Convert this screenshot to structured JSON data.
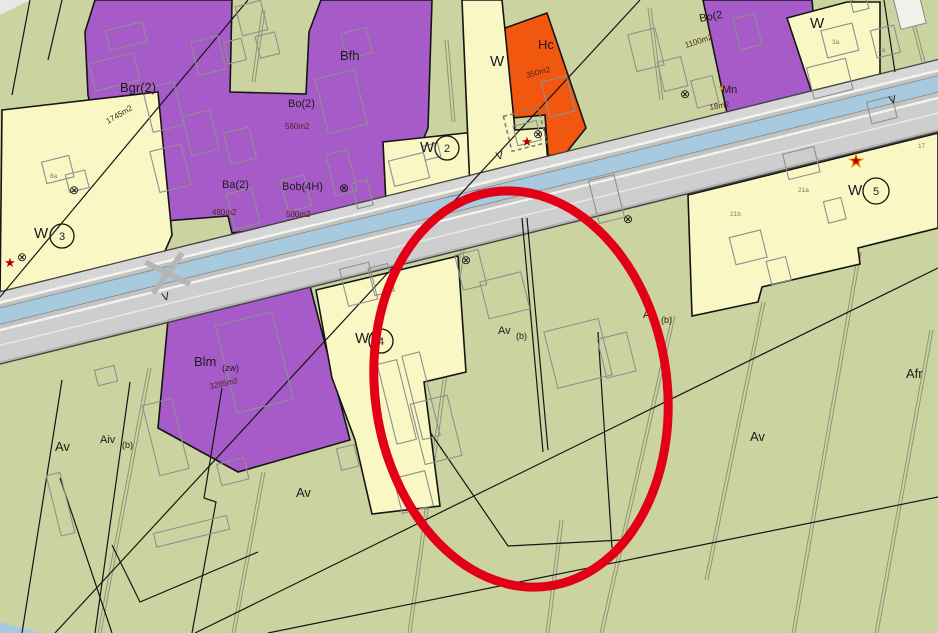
{
  "map": {
    "colors": {
      "farmland_green": "#cbd4a0",
      "zone_purple": "#a75bc9",
      "zone_cream": "#f9f7c4",
      "zone_orange": "#f2570f",
      "road_gray": "#cfcfcf",
      "water_blue": "#a8cade",
      "annotation_red": "#e30016",
      "boundary_black": "#141414",
      "building_outline": "#8f8f8f",
      "star_red": "#b00000",
      "star_orange": "#f09000",
      "area_text_color": "#4a2619"
    },
    "zone_labels": {
      "bgr": "Bgr(2)",
      "bfh": "Bfh",
      "bo2": "Bo(2)",
      "ba2": "Ba(2)",
      "bob4": "Bob(4H)",
      "hc": "Hc",
      "bo2r": "Bo(2",
      "mn": "Mn",
      "blm_main": "Blm",
      "blm_sub": "(zw)",
      "av": "Av",
      "av_sub": "(b)",
      "aiv": "Aiv",
      "afr": "Afr",
      "w": "W",
      "v": "V"
    },
    "area_labels": {
      "bgr": "1745m2",
      "bo2": "560m2",
      "ba2": "480m2",
      "bob4": "500m2",
      "hc": "350m2",
      "bo2r": "1100m2",
      "mn": "18m2",
      "blm": "3285m2"
    },
    "site_numbers": {
      "w2": "2",
      "w3": "3",
      "w4": "4",
      "w5": "5"
    },
    "house_numbers": {
      "h3a": "3a",
      "h2a": "2a",
      "h21a": "21a",
      "h21b": "21b",
      "h17": "17",
      "h8a": "8a"
    },
    "icons": {
      "star": "★",
      "crossed_circle": "⊗"
    },
    "annotation": {
      "shape": "ellipse",
      "color": "#e30016"
    }
  }
}
